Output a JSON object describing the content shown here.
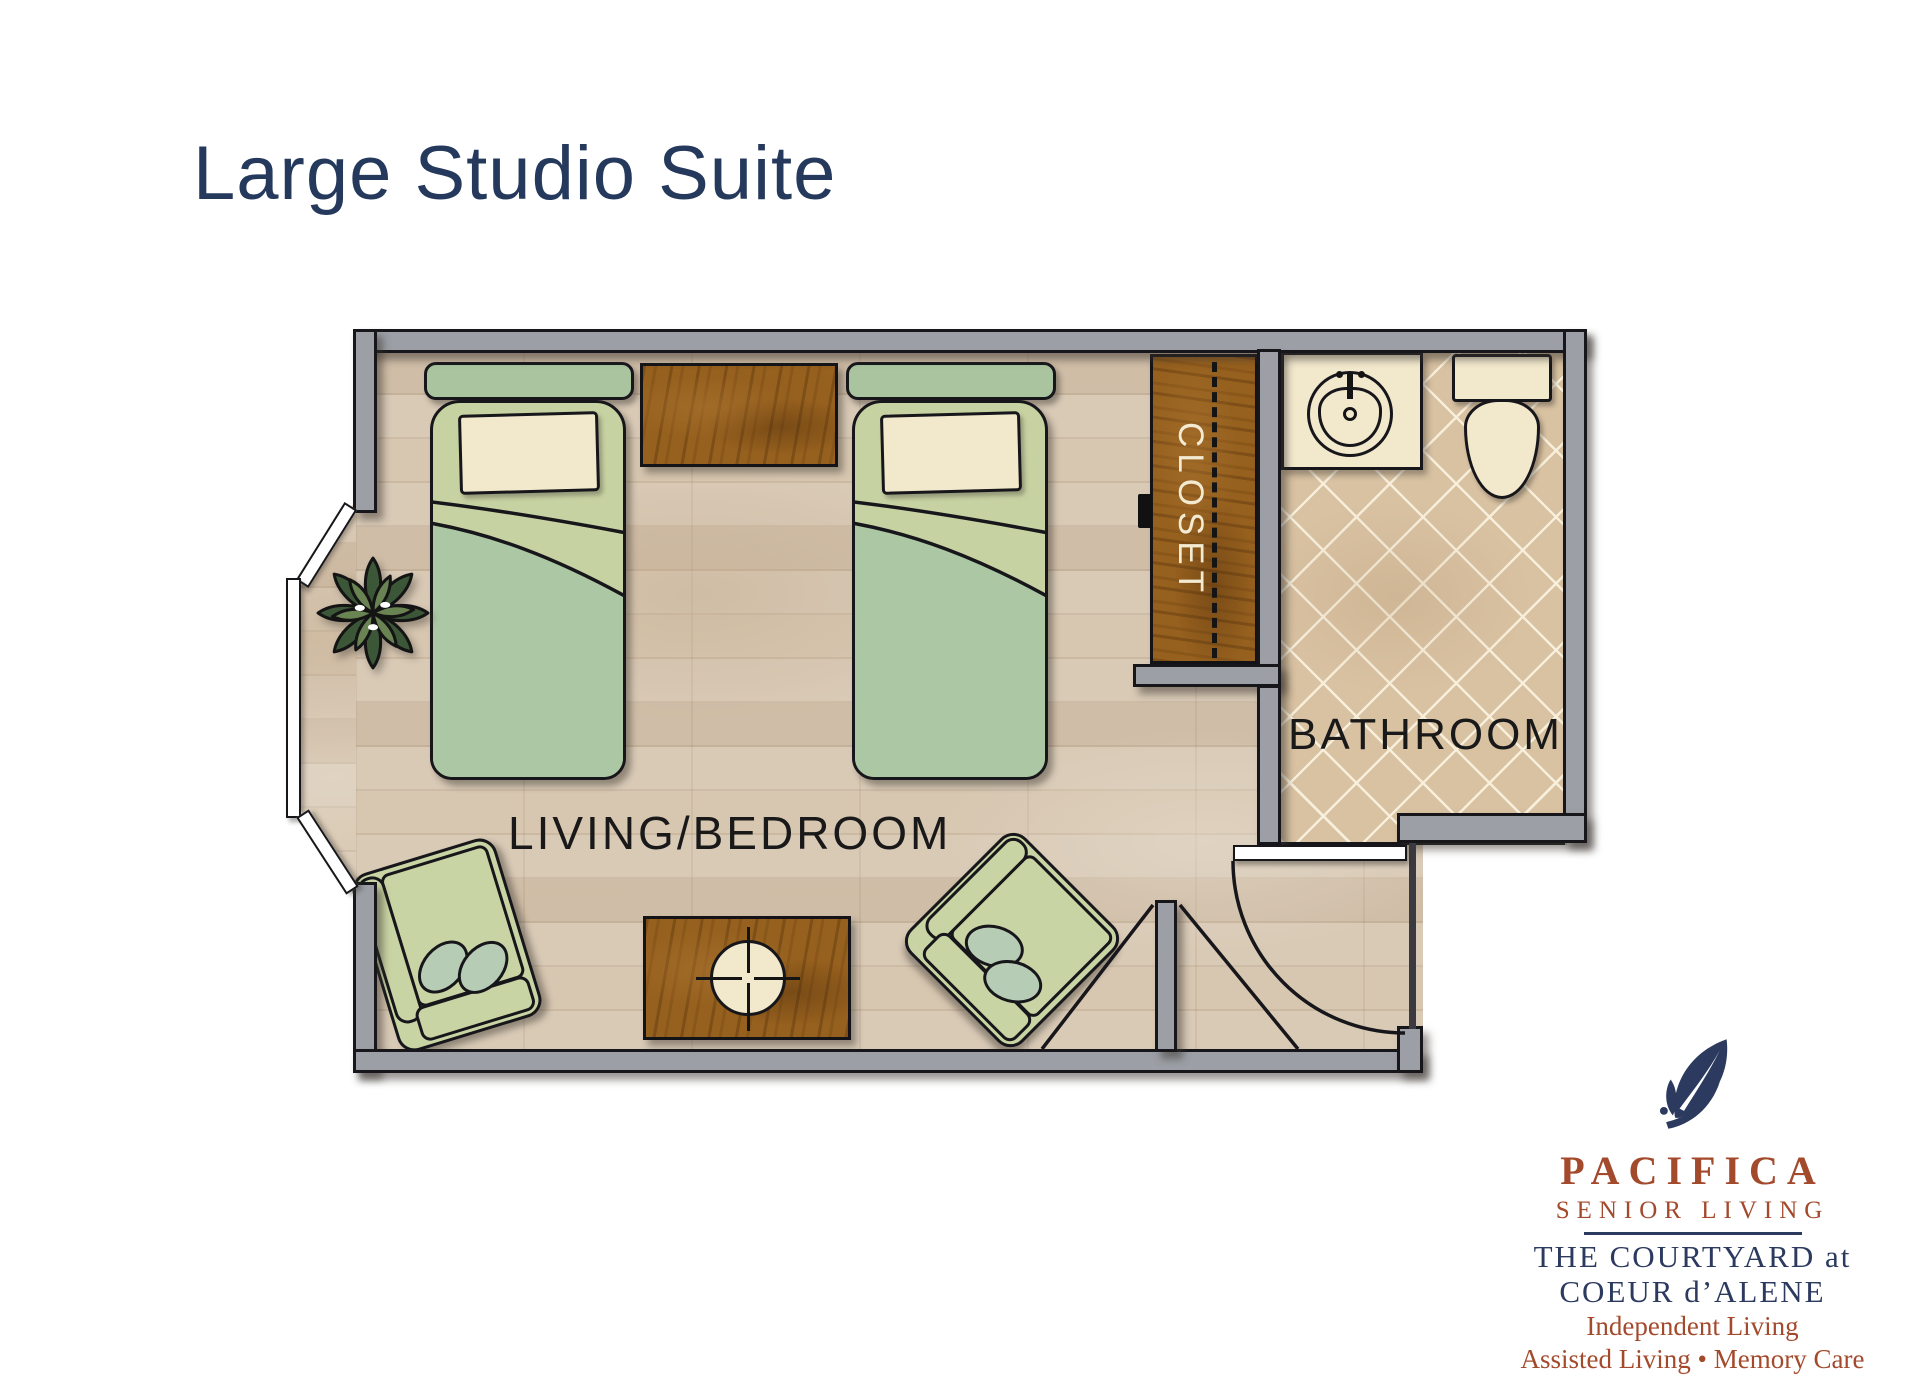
{
  "page": {
    "title": "Large Studio Suite"
  },
  "plan": {
    "labels": {
      "living_bedroom": "LIVING/BEDROOM",
      "bathroom": "BATHROOM",
      "closet": "CLOSET"
    }
  },
  "logo": {
    "brand": "PACIFICA",
    "brand_sub": "SENIOR LIVING",
    "community_line1": "THE COURTYARD at",
    "community_line2": "COEUR d’ALENE",
    "services_line1": "Independent Living",
    "services_line2": "Assisted Living • Memory Care"
  },
  "colors": {
    "title_navy": "#25395c",
    "logo_navy": "#2b3a5e",
    "logo_rust": "#a3492c",
    "wall_gray": "#9ca0a6",
    "floor_wood": "#d9cab6",
    "bathroom_tile": "#d9c2a2",
    "furniture_wood": "#96601e",
    "bed_green": "#c7d2a2",
    "blanket_green": "#abc7a3",
    "pillow_cream": "#f2e9cd"
  }
}
